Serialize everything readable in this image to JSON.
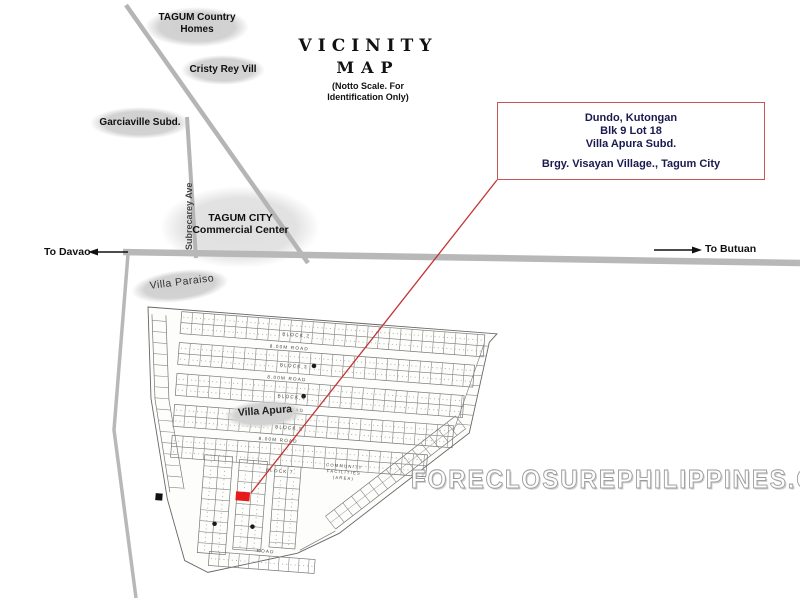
{
  "title": {
    "line1": "VICINITY",
    "line2": "MAP",
    "note_line1": "(Notto Scale. For",
    "note_line2": "Identification Only)"
  },
  "info_box": {
    "line1": "Dundo, Kutongan",
    "line2": "Blk 9 Lot 18",
    "line3": "Villa Apura  Subd.",
    "line4": "Brgy. Visayan Village., Tagum City"
  },
  "landmarks": {
    "tagum_country_homes": {
      "line1": "TAGUM Country",
      "line2": "Homes"
    },
    "cristy_rey_vill": {
      "label": "Cristy Rey Vill"
    },
    "garciaville_subd": {
      "label": "Garciaville Subd."
    },
    "commercial_center": {
      "line1": "TAGUM CITY",
      "line2": "Commercial Center"
    },
    "villa_paraiso": {
      "label": "Villa Paraiso"
    },
    "villa_apura": {
      "label": "Villa Apura"
    }
  },
  "roads": {
    "subrecarey_ave": "Subrecarey Ave",
    "to_davao": "To Davao",
    "to_butuan": "To Butuan"
  },
  "plat": {
    "block_labels": [
      "BLOCK 2",
      "BLOCK 3",
      "BLOCK 4",
      "BLOCK 5",
      "BLOCK 7"
    ],
    "road_labels": [
      "8.00M ROAD",
      "8.00M ROAD",
      "8.00M ROAD",
      "8.00M ROAD"
    ],
    "bottom_road_label": "ROAD",
    "facilities": {
      "line1": "COMMUNITY",
      "line2": "FACILITIES",
      "line3": "(AREA)"
    }
  },
  "watermark": "FORECLOSUREPHILIPPINES.COM",
  "colors": {
    "highlight_red": "#e61c1c",
    "pointer_red": "#c23434",
    "box_border_red": "#c65555",
    "box_text_navy": "#1a1a4e",
    "road_gray": "#b8b8b8",
    "ellipse_gray": "#d4d4d4"
  }
}
